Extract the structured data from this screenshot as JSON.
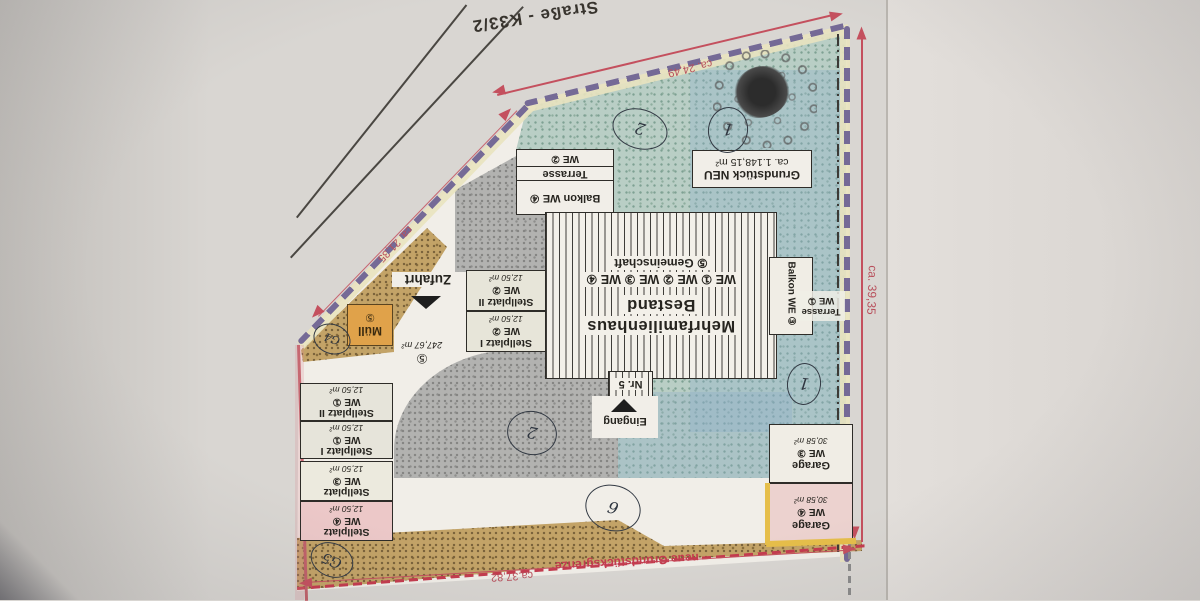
{
  "plan": {
    "street_label": "Straße - K33/2",
    "dimensions": {
      "top": "ca. 24,49",
      "left": "ca. 21,35",
      "right": "ca. 39,35",
      "bottom": "ca.37,82"
    },
    "boundary_label": "neue Grundstücksgrenze",
    "parcel": {
      "title": "Grundstück NEU",
      "area": "ca. 1.148,15 m²"
    },
    "building": {
      "line1": "Mehrfamilienhaus",
      "line2": "Bestand",
      "we_row": "WE ① WE ② WE ③ WE ④",
      "gemeinschaft": "⑤ Gemeinschaft",
      "nr": "Nr. 5",
      "eingang": "Eingang"
    },
    "balcony_we4": {
      "balkon": "Balkon WE ④",
      "terrasse": "Terrasse",
      "we": "WE ②"
    },
    "balcony_we3": "Balkon WE ③",
    "terrace_we1": {
      "l1": "Terrasse",
      "l2": "WE ①"
    },
    "zufahrt": {
      "label": "Zufahrt",
      "num": "⑤",
      "area": "247,67 m²"
    },
    "muell": {
      "label": "Müll",
      "num": "⑤"
    },
    "parking_mid": [
      {
        "l1": "Stellplatz II",
        "l2": "WE ②",
        "area": "12,50 m²"
      },
      {
        "l1": "Stellplatz I",
        "l2": "WE ②",
        "area": "12,50 m²"
      }
    ],
    "parking_left": [
      {
        "l1": "Stellplatz II",
        "l2": "WE ①",
        "area": "12,50 m²"
      },
      {
        "l1": "Stellplatz I",
        "l2": "WE ①",
        "area": "12,50 m²"
      },
      {
        "l1": "Stellplatz",
        "l2": "WE ③",
        "area": "12,50 m²"
      },
      {
        "l1": "Stellplatz",
        "l2": "WE ④",
        "area": "12,50 m²"
      }
    ],
    "garages": [
      {
        "l1": "Garage",
        "l2": "WE ③",
        "area": "30,58 m²"
      },
      {
        "l1": "Garage",
        "l2": "WE ④",
        "area": "30,58 m²"
      }
    ],
    "handwritten": {
      "top_2": "2",
      "top_1": "1",
      "right_1": "1",
      "court_2": "2",
      "bottom_6": "6",
      "g4": "G4",
      "g5": "G5"
    },
    "colors": {
      "boundary_purple": "#756a96",
      "dimension_red": "#c4505e",
      "grenze_red": "#c43b4e",
      "muell_orange": "#e0a24a",
      "highlight_pink": "#ecd2cf",
      "grass": "#b9cec5",
      "paving": "#b2b2b0",
      "soil": "#c3a367"
    }
  }
}
